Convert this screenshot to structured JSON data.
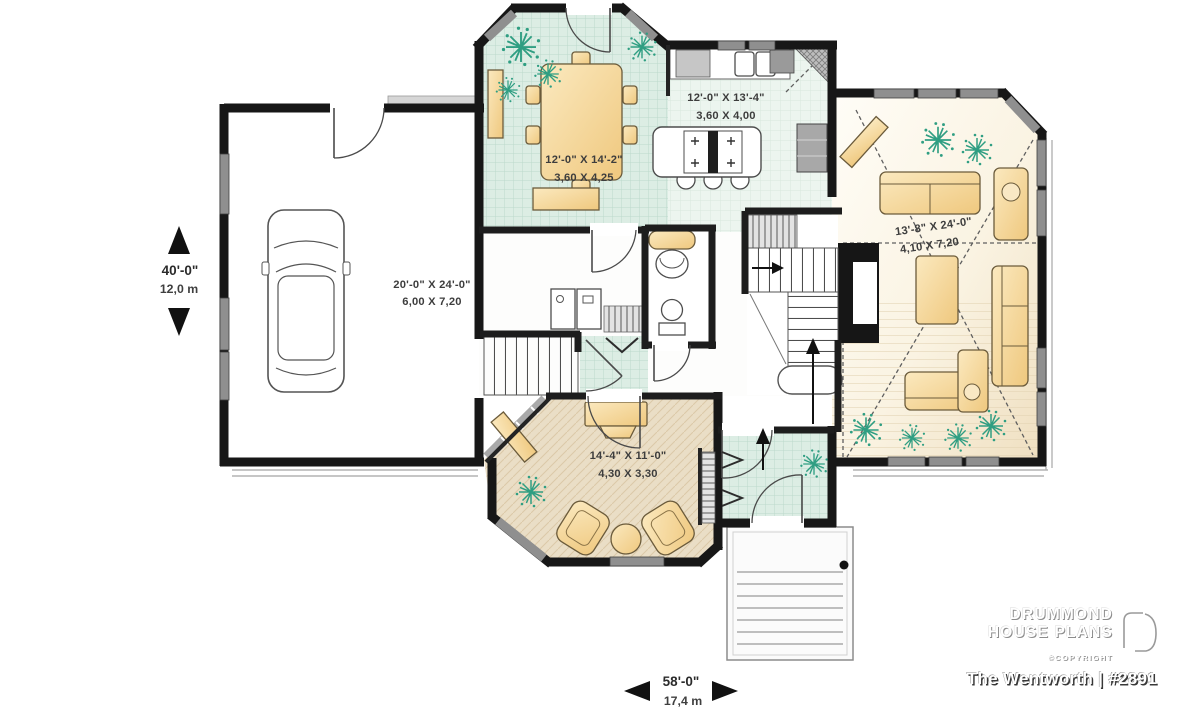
{
  "plan": {
    "rooms": {
      "garage": {
        "imperial": "20'-0\" X 24'-0\"",
        "metric": "6,00 X 7,20"
      },
      "dining": {
        "imperial": "12'-0\" X 14'-2\"",
        "metric": "3,60 X 4,25"
      },
      "kitchen": {
        "imperial": "12'-0\" X 13'-4\"",
        "metric": "3,60 X 4,00"
      },
      "living": {
        "imperial": "13'-8\" X 24'-0\"",
        "metric": "4,10 X 7,20"
      },
      "family": {
        "imperial": "14'-4\" X 11'-0\"",
        "metric": "4,30 X 3,30"
      }
    },
    "overall": {
      "depth_ft": "40'-0\"",
      "depth_m": "12,0 m",
      "width_ft": "58'-0\"",
      "width_m": "17,4 m"
    }
  },
  "branding": {
    "name_line1": "DRUMMOND",
    "name_line2": "HOUSE PLANS",
    "copyright": "©COPYRIGHT",
    "plan_title": "The Wentworth | #2891"
  },
  "colors": {
    "wall": "#171717",
    "tile_teal": "#dcede4",
    "tile_light": "#ecf5ef",
    "wood_floor": "#f0e0c2",
    "furniture": "#f5d89e",
    "plant": "#2f9e82",
    "window": "#8f8f8f"
  }
}
